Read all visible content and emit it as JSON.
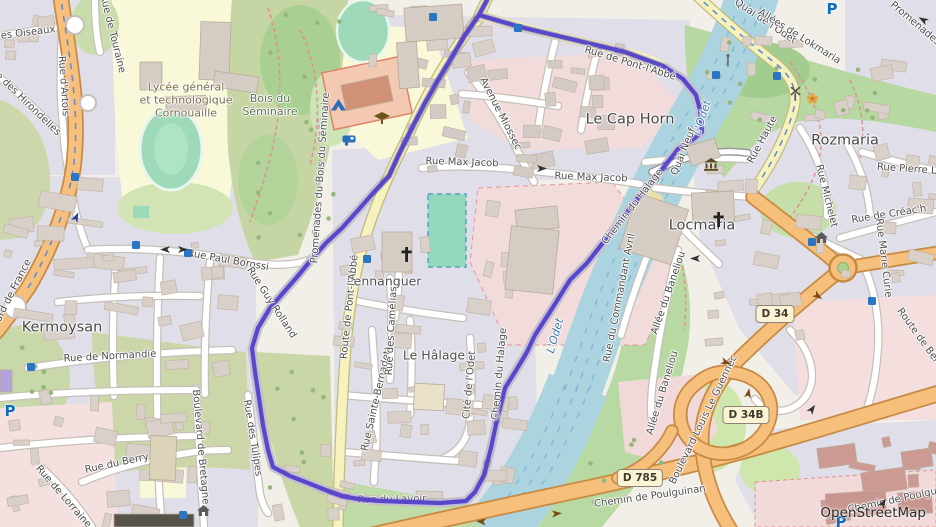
{
  "map": {
    "attribution": "OpenStreetMap",
    "colors": {
      "boundary": "#5847c8",
      "water": "#abd4e0",
      "road_primary": "#f7bf7c",
      "road_secondary": "#f6f1bd",
      "residential": "#e0dee8",
      "pitch": "#9ed9b9",
      "school_area": "#f2dbdb",
      "campus_area": "#f9f9da"
    },
    "boundary": {
      "color": "#5847c8",
      "points": [
        [
          487,
          0
        ],
        [
          479,
          15
        ],
        [
          520,
          27
        ],
        [
          575,
          40
        ],
        [
          625,
          52
        ],
        [
          663,
          66
        ],
        [
          683,
          79
        ],
        [
          696,
          95
        ],
        [
          700,
          110
        ],
        [
          702,
          132
        ],
        [
          691,
          141
        ],
        [
          678,
          149
        ],
        [
          660,
          172
        ],
        [
          643,
          192
        ],
        [
          613,
          230
        ],
        [
          587,
          263
        ],
        [
          570,
          280
        ],
        [
          548,
          315
        ],
        [
          535,
          335
        ],
        [
          527,
          352
        ],
        [
          515,
          372
        ],
        [
          505,
          388
        ],
        [
          498,
          415
        ],
        [
          491,
          448
        ],
        [
          484,
          475
        ],
        [
          475,
          492
        ],
        [
          466,
          501
        ],
        [
          440,
          503
        ],
        [
          410,
          502
        ],
        [
          380,
          501
        ],
        [
          358,
          499
        ],
        [
          342,
          496
        ],
        [
          328,
          491
        ],
        [
          308,
          483
        ],
        [
          290,
          476
        ],
        [
          273,
          467
        ],
        [
          268,
          450
        ],
        [
          263,
          425
        ],
        [
          259,
          398
        ],
        [
          255,
          372
        ],
        [
          252,
          348
        ],
        [
          258,
          328
        ],
        [
          270,
          308
        ],
        [
          283,
          293
        ],
        [
          297,
          277
        ],
        [
          311,
          260
        ],
        [
          326,
          243
        ],
        [
          342,
          228
        ],
        [
          360,
          208
        ],
        [
          374,
          192
        ],
        [
          389,
          176
        ],
        [
          400,
          152
        ],
        [
          412,
          128
        ],
        [
          425,
          103
        ],
        [
          438,
          80
        ],
        [
          452,
          57
        ],
        [
          465,
          35
        ],
        [
          474,
          22
        ],
        [
          479,
          15
        ]
      ]
    },
    "labels": [
      {
        "t": "Kermoysan",
        "x": 62,
        "y": 328,
        "r": 0,
        "c": "pl"
      },
      {
        "t": "Le Cap Horn",
        "x": 630,
        "y": 120,
        "r": 0,
        "c": "pl"
      },
      {
        "t": "Locmaria",
        "x": 702,
        "y": 226,
        "r": 0,
        "c": "pl"
      },
      {
        "t": "Rozmaria",
        "x": 845,
        "y": 141,
        "r": 0,
        "c": "pl"
      },
      {
        "t": "Pennanguer",
        "x": 384,
        "y": 282,
        "r": 0,
        "c": "pl2"
      },
      {
        "t": "Le Hâlage",
        "x": 434,
        "y": 356,
        "r": 0,
        "c": "pl2"
      },
      {
        "t": "Lycée général\net technologique\nCornouaille",
        "x": 186,
        "y": 101,
        "r": 0,
        "c": "sc"
      },
      {
        "t": "Bois du\nSéminaire",
        "x": 270,
        "y": 106,
        "r": 0,
        "c": "ar"
      },
      {
        "t": "L'Odet",
        "x": 703,
        "y": 118,
        "r": -72,
        "c": "wa"
      },
      {
        "t": "L'Odet",
        "x": 556,
        "y": 336,
        "r": -74,
        "c": "wa"
      },
      {
        "t": "Rue des Oiseaux",
        "x": 14,
        "y": 35,
        "r": -7,
        "c": "st"
      },
      {
        "t": "Rue de Touraine",
        "x": 112,
        "y": 34,
        "r": 76,
        "c": "st"
      },
      {
        "t": "Rue d'Artois",
        "x": 63,
        "y": 86,
        "r": 86,
        "c": "st"
      },
      {
        "t": "Rue des Hirondelles",
        "x": 23,
        "y": 100,
        "r": 44,
        "c": "st"
      },
      {
        "t": "Boulevard de France",
        "x": 6,
        "y": 306,
        "r": -63,
        "c": "st"
      },
      {
        "t": "Rue Paul Borossi",
        "x": 228,
        "y": 261,
        "r": 10,
        "c": "st"
      },
      {
        "t": "Rue Guy Rolland",
        "x": 271,
        "y": 303,
        "r": 57,
        "c": "st"
      },
      {
        "t": "Rue de Normandie",
        "x": 110,
        "y": 357,
        "r": -3,
        "c": "st"
      },
      {
        "t": "Rue du Berry",
        "x": 117,
        "y": 464,
        "r": -12,
        "c": "st"
      },
      {
        "t": "Rue de Lorraine",
        "x": 63,
        "y": 497,
        "r": 49,
        "c": "st"
      },
      {
        "t": "Boulevard de Bretagne",
        "x": 200,
        "y": 447,
        "r": 85,
        "c": "st"
      },
      {
        "t": "Rue des Tulipes",
        "x": 252,
        "y": 438,
        "r": 81,
        "c": "st"
      },
      {
        "t": "Route de Pont-l'Abbé",
        "x": 350,
        "y": 307,
        "r": -84,
        "c": "st"
      },
      {
        "t": "Promenades du Bois du Séminaire",
        "x": 321,
        "y": 178,
        "r": -86,
        "c": "st"
      },
      {
        "t": "Rue de Pont-l'Abbé",
        "x": 630,
        "y": 64,
        "r": 17,
        "c": "st"
      },
      {
        "t": "Avenue Miossec",
        "x": 500,
        "y": 114,
        "r": 63,
        "c": "st"
      },
      {
        "t": "Rue Max Jacob",
        "x": 462,
        "y": 163,
        "r": 2,
        "c": "st"
      },
      {
        "t": "Rue Max Jacob",
        "x": 591,
        "y": 178,
        "r": 2,
        "c": "st"
      },
      {
        "t": "Quai de l'Odet",
        "x": 765,
        "y": 22,
        "r": 34,
        "c": "st"
      },
      {
        "t": "Allées de Lokmaria",
        "x": 799,
        "y": 37,
        "r": 32,
        "c": "st"
      },
      {
        "t": "Promenades",
        "x": 915,
        "y": 24,
        "r": 40,
        "c": "st"
      },
      {
        "t": "Rue Haute",
        "x": 763,
        "y": 140,
        "r": -62,
        "c": "st"
      },
      {
        "t": "Quai Neuf",
        "x": 684,
        "y": 152,
        "r": -68,
        "c": "st"
      },
      {
        "t": "Chemin du Halage",
        "x": 633,
        "y": 207,
        "r": -52,
        "c": "st"
      },
      {
        "t": "Chemin du Halage",
        "x": 500,
        "y": 374,
        "r": -85,
        "c": "st"
      },
      {
        "t": "Rue du Commandant Avril",
        "x": 620,
        "y": 298,
        "r": -79,
        "c": "st"
      },
      {
        "t": "Allée du Baneliou",
        "x": 669,
        "y": 293,
        "r": -71,
        "c": "st"
      },
      {
        "t": "Allée du Baneliou",
        "x": 663,
        "y": 393,
        "r": -73,
        "c": "st"
      },
      {
        "t": "Boulevard Louis Le Guennec",
        "x": 704,
        "y": 420,
        "r": -64,
        "c": "st"
      },
      {
        "t": "Chemin de Poulguinan",
        "x": 650,
        "y": 497,
        "r": -8,
        "c": "st"
      },
      {
        "t": "Chemin de Poulguinan",
        "x": 903,
        "y": 499,
        "r": -12,
        "c": "st"
      },
      {
        "t": "Route de Bénodet",
        "x": 925,
        "y": 346,
        "r": 54,
        "c": "st"
      },
      {
        "t": "Rue Pierre Loti",
        "x": 913,
        "y": 170,
        "r": 4,
        "c": "st"
      },
      {
        "t": "Rue Michelet",
        "x": 826,
        "y": 196,
        "r": 76,
        "c": "st"
      },
      {
        "t": "Rue de Créac'h",
        "x": 889,
        "y": 215,
        "r": -9,
        "c": "st"
      },
      {
        "t": "Rue Marie Curie",
        "x": 883,
        "y": 258,
        "r": 83,
        "c": "st"
      },
      {
        "t": "Rue Sainte-Bernadette",
        "x": 378,
        "y": 396,
        "r": -77,
        "c": "st"
      },
      {
        "t": "Rue des Camélias",
        "x": 392,
        "y": 331,
        "r": -87,
        "c": "st"
      },
      {
        "t": "Cité de l'Odet",
        "x": 470,
        "y": 385,
        "r": -85,
        "c": "st"
      },
      {
        "t": "Rue du Lavoir",
        "x": 392,
        "y": 500,
        "r": -1,
        "c": "un",
        "layer": "under"
      }
    ],
    "shields": [
      {
        "text": "D 34",
        "x": 775,
        "y": 314
      },
      {
        "text": "D 34B",
        "x": 746,
        "y": 415
      },
      {
        "text": "D 785",
        "x": 640,
        "y": 478
      }
    ],
    "icons": [
      {
        "k": "bus",
        "x": 136,
        "y": 245
      },
      {
        "k": "bus",
        "x": 188,
        "y": 253
      },
      {
        "k": "bus",
        "x": 75,
        "y": 177
      },
      {
        "k": "bus",
        "x": 433,
        "y": 17
      },
      {
        "k": "bus",
        "x": 518,
        "y": 28
      },
      {
        "k": "bus",
        "x": 367,
        "y": 259
      },
      {
        "k": "bus",
        "x": 31,
        "y": 367
      },
      {
        "k": "bus",
        "x": 183,
        "y": 515
      },
      {
        "k": "bus",
        "x": 716,
        "y": 75
      },
      {
        "k": "bus",
        "x": 777,
        "y": 76
      },
      {
        "k": "bus",
        "x": 812,
        "y": 242
      },
      {
        "k": "bus",
        "x": 872,
        "y": 301
      },
      {
        "k": "parking",
        "g": "P",
        "x": 832,
        "y": 9
      },
      {
        "k": "parking",
        "g": "P",
        "x": 10,
        "y": 411
      },
      {
        "k": "parking",
        "g": "P",
        "x": 841,
        "y": 522
      },
      {
        "k": "church",
        "x": 398,
        "y": 246
      },
      {
        "k": "church",
        "x": 710,
        "y": 211
      },
      {
        "k": "museum",
        "x": 703,
        "y": 158
      },
      {
        "k": "school",
        "x": 374,
        "y": 112
      },
      {
        "k": "tent",
        "x": 331,
        "y": 99
      },
      {
        "k": "caravan",
        "x": 342,
        "y": 135
      },
      {
        "k": "windmill",
        "x": 789,
        "y": 87
      },
      {
        "k": "mast",
        "x": 724,
        "y": 54
      },
      {
        "k": "flower",
        "x": 806,
        "y": 92
      },
      {
        "k": "home",
        "x": 815,
        "y": 232
      },
      {
        "k": "home",
        "x": 197,
        "y": 505
      },
      {
        "k": "arrow",
        "x": 70,
        "y": 212,
        "r": -65,
        "col": "#27408b"
      },
      {
        "k": "arrow",
        "x": 158,
        "y": 245,
        "r": 180,
        "col": "#333333"
      },
      {
        "k": "arrow",
        "x": 177,
        "y": 245,
        "r": 0,
        "col": "#333333"
      },
      {
        "k": "arrow",
        "x": 536,
        "y": 164,
        "r": 0,
        "col": "#333333"
      },
      {
        "k": "arrow",
        "x": 688,
        "y": 254,
        "r": 180,
        "col": "#333333"
      },
      {
        "k": "arrow",
        "x": 812,
        "y": 292,
        "r": 35,
        "col": "#7a4a12"
      },
      {
        "k": "arrow",
        "x": 742,
        "y": 388,
        "r": -80,
        "col": "#7a4a12"
      },
      {
        "k": "arrow",
        "x": 720,
        "y": 358,
        "r": 20,
        "col": "#7a4a12"
      },
      {
        "k": "arrow",
        "x": 474,
        "y": 517,
        "r": 185,
        "col": "#7a4a12"
      },
      {
        "k": "arrow",
        "x": 551,
        "y": 509,
        "r": -5,
        "col": "#7a4a12"
      },
      {
        "k": "arrow",
        "x": 916,
        "y": 15,
        "r": 210,
        "col": "#333333"
      },
      {
        "k": "arrow",
        "x": 806,
        "y": 404,
        "r": -55,
        "col": "#333333"
      },
      {
        "k": "arrow",
        "x": 877,
        "y": 498,
        "r": -60,
        "col": "#333333"
      }
    ]
  }
}
